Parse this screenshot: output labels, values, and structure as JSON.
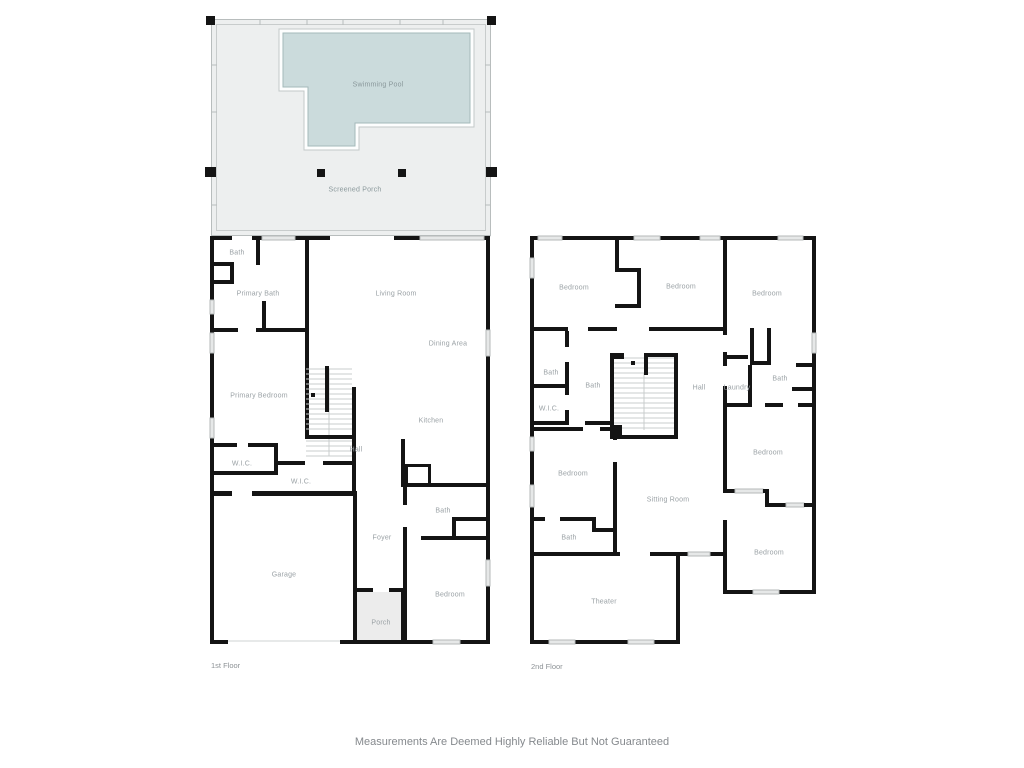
{
  "page": {
    "footer": "Measurements Are Deemed Highly Reliable But Not Guaranteed"
  },
  "colors": {
    "wall": "#141414",
    "porch_fill": "#edefef",
    "pool_fill": "#cbdbdc",
    "pool_stroke": "#a4b9ba",
    "window_fill": "#e6e8e8",
    "label": "#9aa1a5",
    "footer": "#85898d"
  },
  "outdoor": {
    "pool_label": "Swimming Pool",
    "porch_label": "Screened Porch"
  },
  "floors": [
    {
      "name": "1st Floor",
      "rooms": [
        {
          "label": "Bath",
          "x": 237,
          "y": 253
        },
        {
          "label": "Primary Bath",
          "x": 258,
          "y": 294
        },
        {
          "label": "Living Room",
          "x": 396,
          "y": 294
        },
        {
          "label": "Dining Area",
          "x": 448,
          "y": 344
        },
        {
          "label": "Primary Bedroom",
          "x": 259,
          "y": 396
        },
        {
          "label": "Kitchen",
          "x": 431,
          "y": 421
        },
        {
          "label": "Hall",
          "x": 356,
          "y": 450
        },
        {
          "label": "W.I.C.",
          "x": 242,
          "y": 464
        },
        {
          "label": "W.I.C.",
          "x": 301,
          "y": 482
        },
        {
          "label": "Foyer",
          "x": 382,
          "y": 538
        },
        {
          "label": "Bath",
          "x": 443,
          "y": 511
        },
        {
          "label": "Garage",
          "x": 284,
          "y": 575
        },
        {
          "label": "Bedroom",
          "x": 450,
          "y": 595
        },
        {
          "label": "Porch",
          "x": 381,
          "y": 623
        }
      ]
    },
    {
      "name": "2nd Floor",
      "rooms": [
        {
          "label": "Bedroom",
          "x": 574,
          "y": 288
        },
        {
          "label": "Bedroom",
          "x": 681,
          "y": 287
        },
        {
          "label": "Bedroom",
          "x": 767,
          "y": 294
        },
        {
          "label": "Bath",
          "x": 551,
          "y": 373
        },
        {
          "label": "Bath",
          "x": 593,
          "y": 386
        },
        {
          "label": "W.I.C.",
          "x": 549,
          "y": 409
        },
        {
          "label": "Hall",
          "x": 699,
          "y": 388
        },
        {
          "label": "Laundry",
          "x": 737,
          "y": 388
        },
        {
          "label": "Bath",
          "x": 780,
          "y": 379
        },
        {
          "label": "Bedroom",
          "x": 768,
          "y": 453
        },
        {
          "label": "Bedroom",
          "x": 573,
          "y": 474
        },
        {
          "label": "Sitting Room",
          "x": 668,
          "y": 500
        },
        {
          "label": "Bath",
          "x": 569,
          "y": 538
        },
        {
          "label": "Bedroom",
          "x": 769,
          "y": 553
        },
        {
          "label": "Theater",
          "x": 604,
          "y": 602
        }
      ]
    }
  ]
}
